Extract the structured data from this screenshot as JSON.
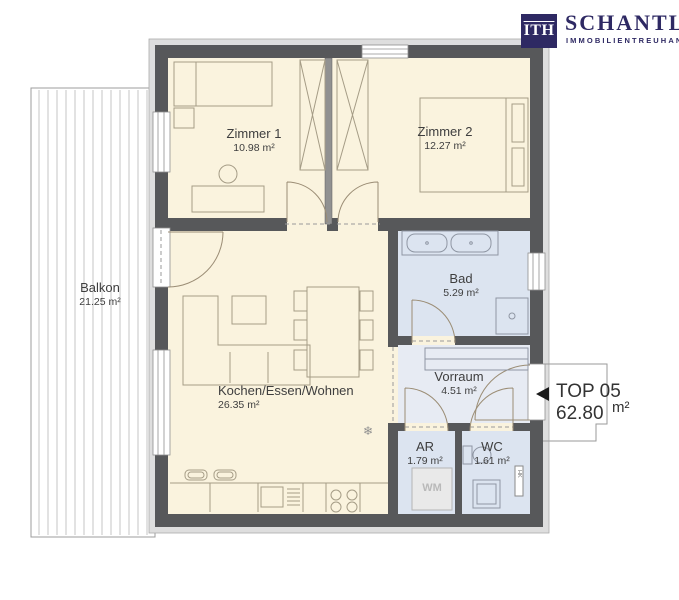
{
  "brand": {
    "logo_mark": "ITH",
    "name": "SCHANTL",
    "tagline": "IMMOBILIENTREUHAND",
    "color": "#2E2963"
  },
  "unit": {
    "label": "TOP 05",
    "area_value": "62.80",
    "area_unit": "m²"
  },
  "rooms": [
    {
      "id": "zimmer-1",
      "name": "Zimmer 1",
      "area": "10.98 m²"
    },
    {
      "id": "zimmer-2",
      "name": "Zimmer 2",
      "area": "12.27 m²"
    },
    {
      "id": "bad",
      "name": "Bad",
      "area": "5.29 m²"
    },
    {
      "id": "vorraum",
      "name": "Vorraum",
      "area": "4.51 m²"
    },
    {
      "id": "ar",
      "name": "AR",
      "area": "1.79 m²"
    },
    {
      "id": "wc",
      "name": "WC",
      "area": "1.61 m²"
    },
    {
      "id": "kochen-essen-wohnen",
      "name": "Kochen/Essen/Wohnen",
      "area": "26.35 m²"
    },
    {
      "id": "balkon",
      "name": "Balkon",
      "area": "21.25 m²"
    }
  ],
  "appliances": {
    "washing_machine": "WM",
    "radiator": "HK"
  },
  "icons": {
    "snowflake": "❄",
    "entry_arrow": "left-triangle"
  },
  "colors": {
    "wall": "#57585A",
    "room_warm": "#FAF3DE",
    "room_wet": "#DCE4F0",
    "balcony_stripe": "#C9C9C9",
    "brand_navy": "#2E2963"
  }
}
